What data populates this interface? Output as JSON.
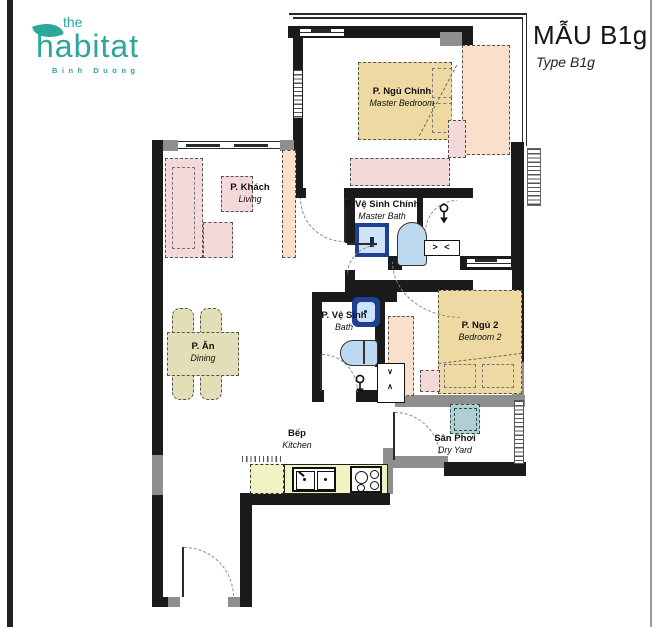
{
  "logo": {
    "the": "the",
    "name": "habitat",
    "location": "Binh Duong",
    "color": "#2ba79b"
  },
  "header": {
    "title": "MẪU B1g",
    "subtitle": "Type B1g"
  },
  "rooms": {
    "master_bedroom": {
      "vi": "P. Ngủ Chính",
      "en": "Master Bedroom"
    },
    "master_bath": {
      "vi": "P. Vệ Sinh Chính",
      "en": "Master Bath"
    },
    "living": {
      "vi": "P. Khách",
      "en": "Living"
    },
    "dining": {
      "vi": "P. Ăn",
      "en": "Dining"
    },
    "bath": {
      "vi": "P. Vệ Sinh",
      "en": "Bath"
    },
    "bedroom2": {
      "vi": "P. Ngủ 2",
      "en": "Bedroom 2"
    },
    "kitchen": {
      "vi": "Bếp",
      "en": "Kitchen"
    },
    "dry_yard": {
      "vi": "Sân Phơi",
      "en": "Dry Yard"
    }
  },
  "markers": {
    "vent": "> <",
    "shaft_top": "∨",
    "shaft_bottom": "∧"
  },
  "colors": {
    "wall": "#1b1b1b",
    "wall_gray": "#8e8e8e",
    "logo_teal": "#2ba79b",
    "bed_tan": "#edd9a1",
    "furniture_pink": "#f4d9db",
    "furniture_peach": "#fadfcb",
    "dining_khaki": "#e2dfb8",
    "counter_yellow": "#f1f3c3",
    "fixture_blue_light": "#bcd9f0",
    "fixture_blue_dark": "#1d3f96",
    "washer_teal": "#afcfd3"
  }
}
